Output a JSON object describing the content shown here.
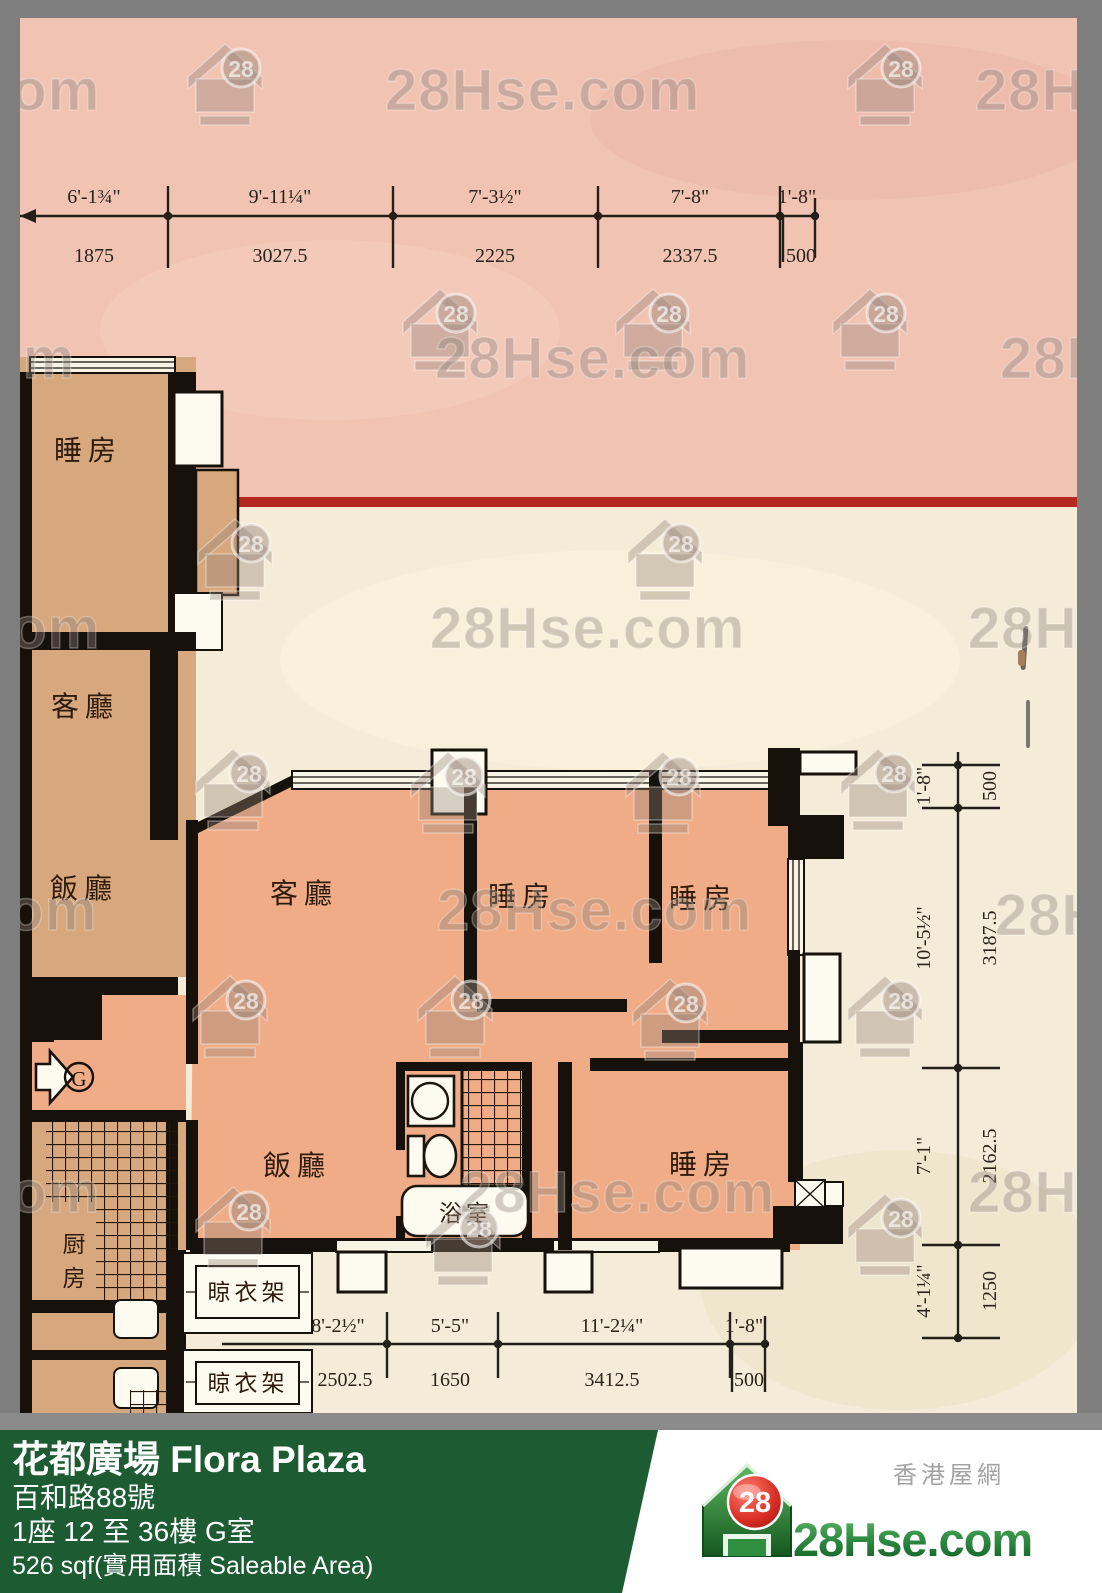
{
  "watermark": {
    "text": "28Hse.com",
    "badge": "28"
  },
  "plan": {
    "rooms": {
      "bedroom": "睡房",
      "living": "客廳",
      "dining": "飯廳",
      "kitchen": "厨房",
      "bathroom": "浴室",
      "drying_rack": "晾衣架",
      "entrance_label": "G"
    },
    "dimensions": {
      "top": {
        "segments": [
          {
            "ft": "6'-1¾\"",
            "mm": "1875"
          },
          {
            "ft": "9'-11¼\"",
            "mm": "3027.5"
          },
          {
            "ft": "7'-3½\"",
            "mm": "2225"
          },
          {
            "ft": "7'-8\"",
            "mm": "2337.5"
          },
          {
            "ft": "1'-8\"",
            "mm": "500"
          }
        ]
      },
      "right": {
        "segments": [
          {
            "ft": "1'-8\"",
            "mm": "500"
          },
          {
            "ft": "10'-5½\"",
            "mm": "3187.5"
          },
          {
            "ft": "7'-1\"",
            "mm": "2162.5"
          },
          {
            "ft": "4'-1¼\"",
            "mm": "1250"
          }
        ]
      },
      "bottom": {
        "segments": [
          {
            "ft": "8'-2½\"",
            "mm": "2502.5"
          },
          {
            "ft": "5'-5\"",
            "mm": "1650"
          },
          {
            "ft": "11'-2¼\"",
            "mm": "3412.5"
          },
          {
            "ft": "1'-8\"",
            "mm": "500"
          }
        ]
      }
    }
  },
  "footer": {
    "estate_name": "花都廣場 Flora Plaza",
    "address": "百和路88號",
    "floor_unit": "1座 12 至 36樓 G室",
    "area": "526 sqf(實用面積 Saleable Area)"
  },
  "logo": {
    "site_cn": "香港屋網",
    "site_name": "28Hse.com",
    "badge": "28"
  },
  "colors": {
    "footer_green": "#1d5b33",
    "red_line": "#b5281f",
    "scan_pink": "#f1c3b3",
    "scan_cream": "#f4ecd8",
    "unit_salmon": "#efac87",
    "unit_tan": "#d7a77d",
    "logo_green": "#2e8b42",
    "logo_red": "#c62828"
  }
}
